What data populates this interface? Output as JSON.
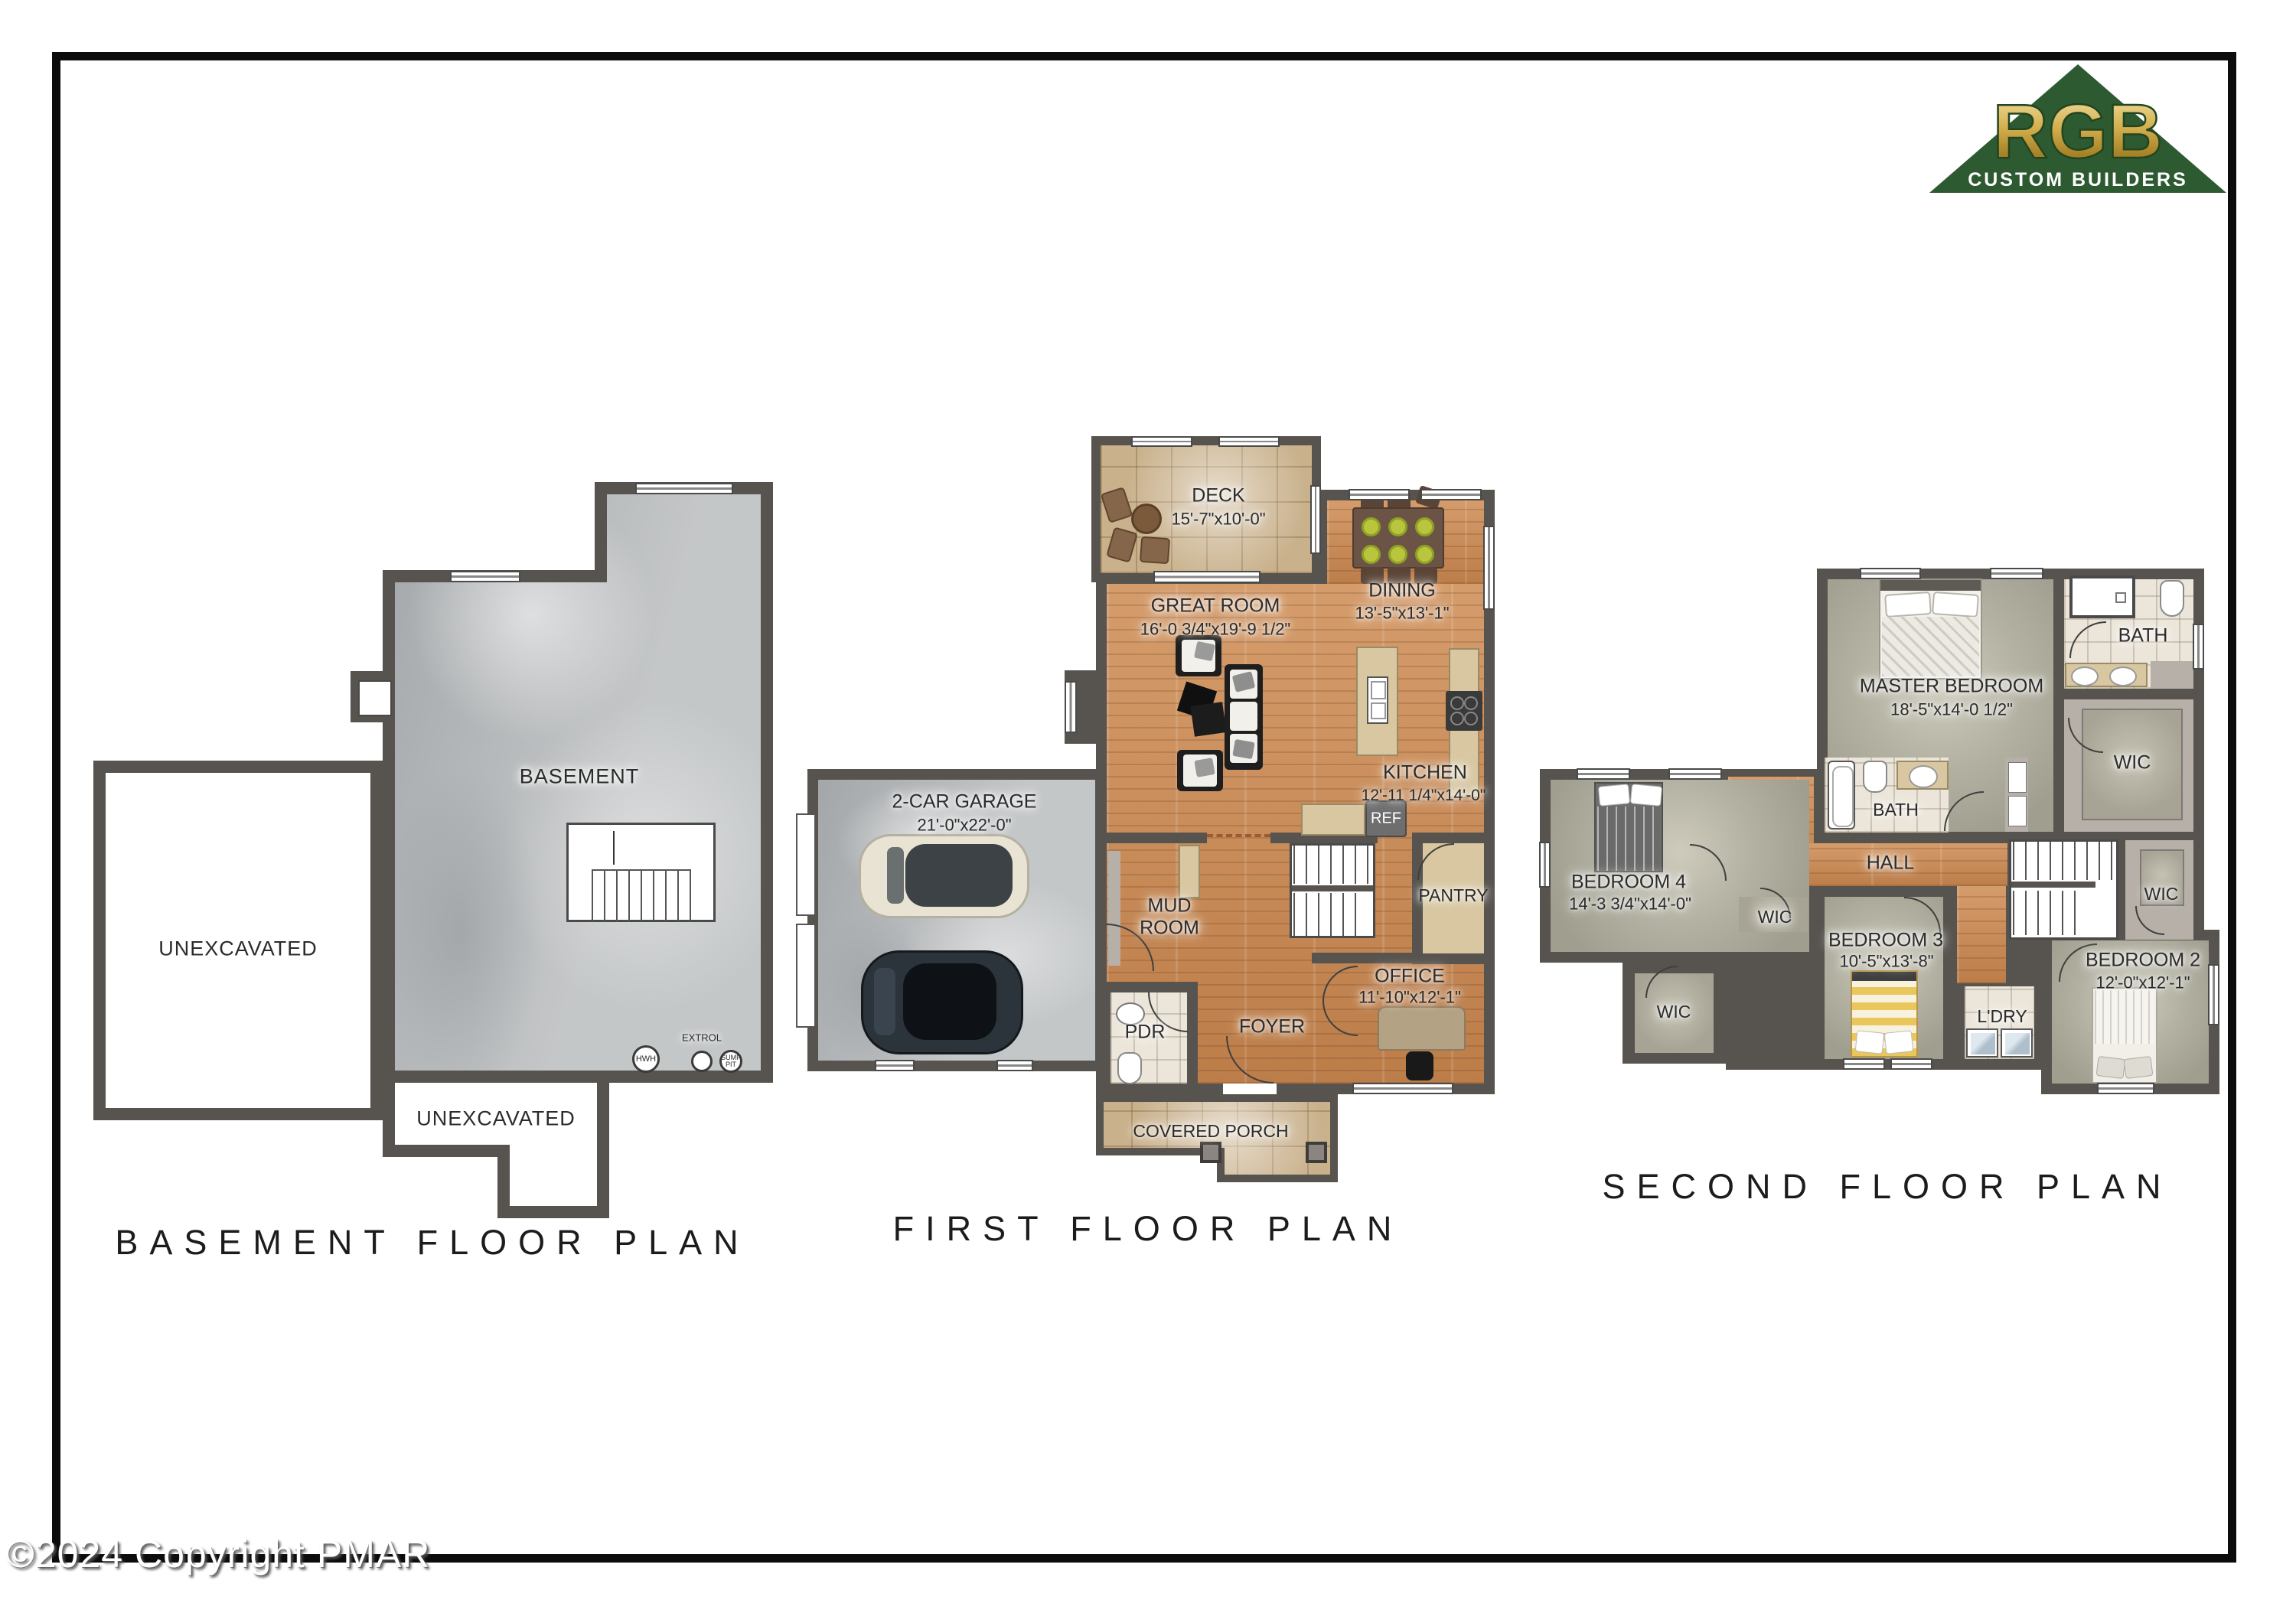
{
  "page": {
    "copyright": "©2024 Copyright PMAR"
  },
  "logo": {
    "initials": "RGB",
    "tagline": "CUSTOM BUILDERS",
    "green": "#2e5a31",
    "gold": "#c9a43f"
  },
  "colors": {
    "wall": "#57534e",
    "wood": "#c68a58",
    "carpet": "#a7a496",
    "concrete": "#b4b7b9"
  },
  "plans": {
    "basement": {
      "title": "BASEMENT FLOOR PLAN",
      "rooms": {
        "basement": "BASEMENT",
        "unexcavated_left": "UNEXCAVATED",
        "unexcavated_bottom": "UNEXCAVATED"
      },
      "equipment": {
        "hwh": "HWH",
        "extrol": "EXTROL",
        "sump": "SUMP PIT"
      }
    },
    "first": {
      "title": "FIRST FLOOR PLAN",
      "rooms": {
        "deck": {
          "name": "DECK",
          "dims": "15'-7\"x10'-0\""
        },
        "great": {
          "name": "GREAT ROOM",
          "dims": "16'-0 3/4\"x19'-9 1/2\""
        },
        "dining": {
          "name": "DINING",
          "dims": "13'-5\"x13'-1\""
        },
        "kitchen": {
          "name": "KITCHEN",
          "dims": "12'-11 1/4\"x14'-0\""
        },
        "garage": {
          "name": "2-CAR GARAGE",
          "dims": "21'-0\"x22'-0\""
        },
        "mud": {
          "name": "MUD ROOM"
        },
        "pdr": {
          "name": "PDR"
        },
        "foyer": {
          "name": "FOYER"
        },
        "office": {
          "name": "OFFICE",
          "dims": "11'-10\"x12'-1\""
        },
        "pantry": {
          "name": "PANTRY"
        },
        "ref": {
          "name": "REF"
        },
        "porch": {
          "name": "COVERED PORCH"
        }
      }
    },
    "second": {
      "title": "SECOND FLOOR PLAN",
      "rooms": {
        "master": {
          "name": "MASTER BEDROOM",
          "dims": "18'-5\"x14'-0 1/2\""
        },
        "bath_top": {
          "name": "BATH"
        },
        "wic_master": {
          "name": "WIC"
        },
        "bath_hall": {
          "name": "BATH"
        },
        "hall": {
          "name": "HALL"
        },
        "wic_hall": {
          "name": "WIC"
        },
        "bed4": {
          "name": "BEDROOM 4",
          "dims": "14'-3 3/4\"x14'-0\""
        },
        "wic_bed4": {
          "name": "WIC"
        },
        "bed3": {
          "name": "BEDROOM 3",
          "dims": "10'-5\"x13'-8\""
        },
        "ldry": {
          "name": "L'DRY"
        },
        "bed2": {
          "name": "BEDROOM 2",
          "dims": "12'-0\"x12'-1\""
        }
      }
    }
  }
}
